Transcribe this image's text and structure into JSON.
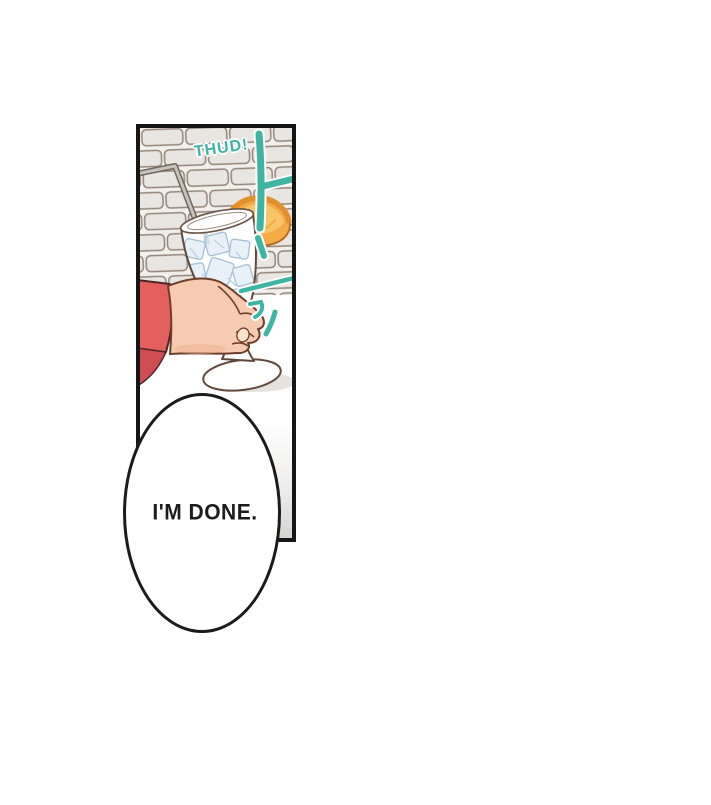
{
  "page": {
    "background_color": "#ffffff",
    "content_type": "comic-panel"
  },
  "panel": {
    "sfx": {
      "text": "THUD!",
      "color": "#3eb5a3"
    },
    "elements": [
      "brick-wall",
      "straw",
      "orange-slice",
      "glass-of-iced-drink",
      "ice-cubes",
      "hand",
      "red-sleeve",
      "table",
      "impact-marks"
    ],
    "colors": {
      "panel_border": "#161616",
      "accent_teal": "#3eb5a3",
      "brick_fill": "#e9e5e1",
      "brick_line": "#93857a",
      "mortar": "#f3f0ec",
      "skin": "#f7cbb1",
      "skin_outline": "#6f3c28",
      "sleeve_red": "#e4605e",
      "sleeve_shadow": "#cf4d52",
      "orange_flesh": "#f4ab45",
      "orange_inner": "#f7c568",
      "orange_peel": "#e28f2e",
      "ice_fill": "#e9f1f8",
      "ice_line": "#a9c2d8",
      "glass_outline": "#5f4a3c",
      "drink_amber": "#eaa449",
      "table_shadow": "#e5e2df",
      "text_black": "#1c1c1c"
    }
  },
  "bubble": {
    "text": "I'M DONE."
  }
}
